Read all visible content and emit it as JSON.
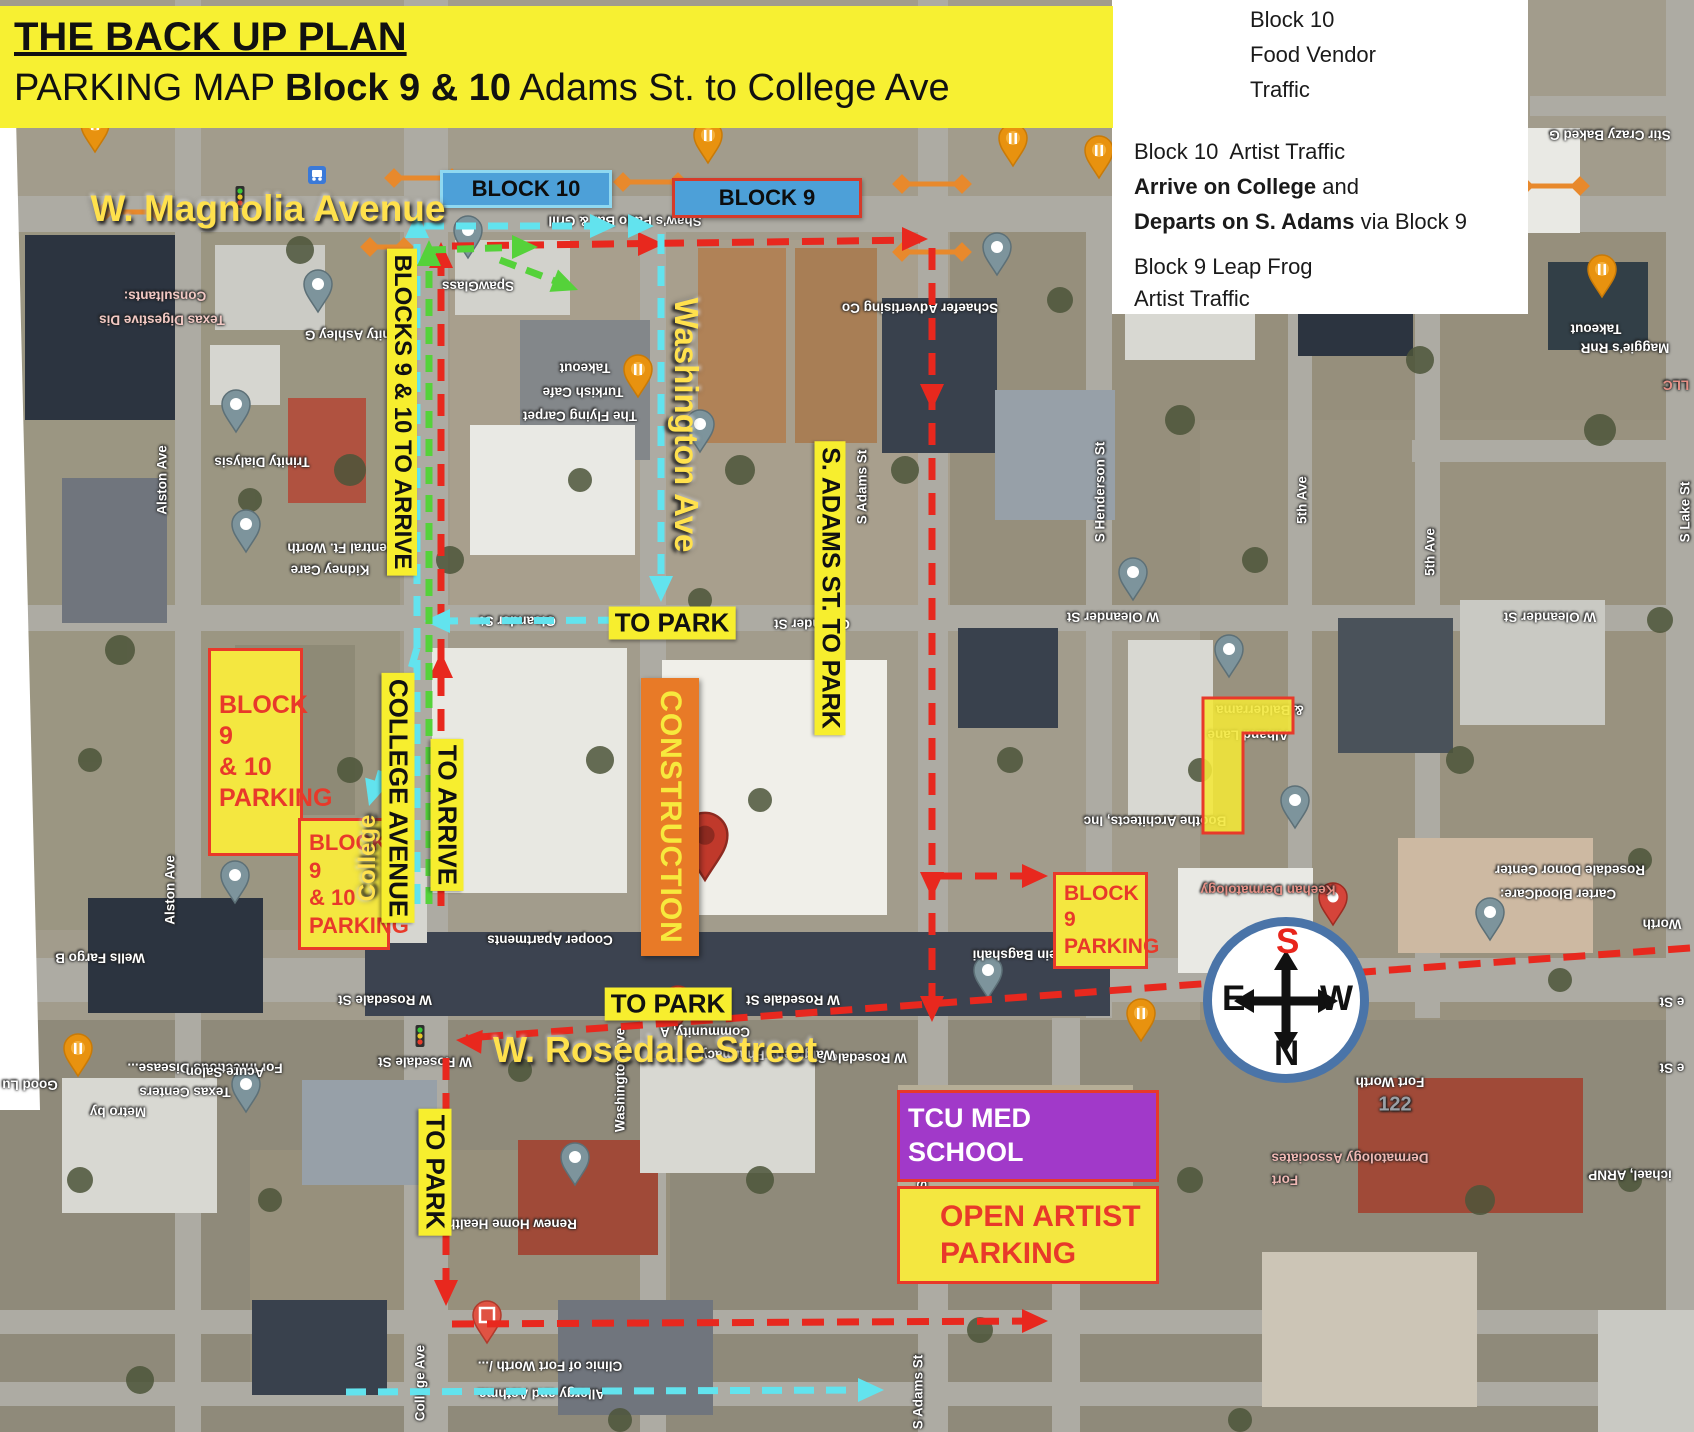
{
  "banner": {
    "title": "THE BACK UP PLAN",
    "subtitle_prefix": "PARKING MAP ",
    "subtitle_bold": "Block 9 & 10",
    "subtitle_suffix": " Adams St. to College Ave"
  },
  "legend": {
    "item1": {
      "l1": "Block 10",
      "l2": "Food Vendor",
      "l3": "Traffic"
    },
    "item2": {
      "l1": "Block 10  Artist Traffic",
      "l2b": "Arrive on College",
      "l2r": " and",
      "l3b": "Departs on S. Adams",
      "l3r": " via Block 9"
    },
    "item3": {
      "l1": "Block 9 Leap Frog",
      "l2": "Artist Traffic"
    }
  },
  "compass": {
    "top": "S",
    "left": "E",
    "right": "W",
    "bottom": "N"
  },
  "construction_label": "CONSTRUCTION",
  "colors": {
    "banner_yellow": "#f7f032",
    "label_yellow": "#f7ee2e",
    "street_text_yellow": "#ffe14d",
    "route_red": "#e8281e",
    "route_cyan": "#62e3ee",
    "route_green": "#55d23a",
    "closure_orange": "#e8892c",
    "construction_orange": "#e87a27",
    "parking_fill": "#f4e740",
    "parking_border": "#e8392a",
    "tcu_purple": "#a139c9",
    "block_tag_blue": "#4da0d8",
    "compass_ring_blue": "#4a74a8",
    "compass_s_red": "#e8251c"
  },
  "block_tags": [
    {
      "name": "block-10-tag",
      "label": "BLOCK 10",
      "x": 440,
      "y": 170,
      "w": 172,
      "h": 38,
      "fill": "#4da0d8",
      "border": "#8fd8f0",
      "size": 22
    },
    {
      "name": "block-9-tag",
      "label": "BLOCK 9",
      "x": 672,
      "y": 178,
      "w": 190,
      "h": 40,
      "fill": "#4da0d8",
      "border": "#d63a2a",
      "size": 22
    }
  ],
  "overlay_labels": [
    {
      "name": "magnolia-avenue-label",
      "text": "W. Magnolia Avenue",
      "x": 268,
      "y": 209,
      "rot": 0,
      "style": "ytext",
      "size": 37
    },
    {
      "name": "rosedale-street-label",
      "text": "W. Rosedale Street",
      "x": 655,
      "y": 1050,
      "rot": 0,
      "style": "ytext",
      "size": 36
    },
    {
      "name": "washington-ave-label",
      "text": "Washington Ave",
      "x": 686,
      "y": 425,
      "rot": 90,
      "style": "ytext",
      "size": 33
    },
    {
      "name": "college-script-label",
      "text": "College",
      "x": 368,
      "y": 858,
      "rot": -90,
      "style": "ytext",
      "size": 24
    },
    {
      "name": "blocks-9-10-to-arrive-label",
      "text": "BLOCKS 9 & 10 TO ARRIVE",
      "x": 402,
      "y": 412,
      "rot": 90,
      "style": "ybox",
      "size": 24
    },
    {
      "name": "s-adams-to-park-label",
      "text": "S. ADAMS ST. TO PARK",
      "x": 830,
      "y": 588,
      "rot": 90,
      "style": "ybox",
      "size": 25
    },
    {
      "name": "to-park-oleander-label",
      "text": "TO PARK",
      "x": 672,
      "y": 623,
      "rot": 0,
      "style": "ybox",
      "size": 26
    },
    {
      "name": "college-avenue-label",
      "text": "COLLEGE AVENUE",
      "x": 398,
      "y": 798,
      "rot": 90,
      "style": "ybox",
      "size": 26
    },
    {
      "name": "to-arrive-label",
      "text": "TO ARRIVE",
      "x": 447,
      "y": 815,
      "rot": 90,
      "style": "ybox",
      "size": 26
    },
    {
      "name": "to-park-rosedale-label",
      "text": "TO PARK",
      "x": 668,
      "y": 1004,
      "rot": 0,
      "style": "ybox",
      "size": 26
    },
    {
      "name": "to-park-college-label",
      "text": "TO PARK",
      "x": 435,
      "y": 1172,
      "rot": 90,
      "style": "ybox",
      "size": 26
    }
  ],
  "parking_boxes": [
    {
      "name": "block-9-10-parking-large",
      "lines": [
        "BLOCK 9",
        "& 10",
        "PARKING"
      ],
      "x": 208,
      "y": 648,
      "w": 95,
      "h": 208,
      "fill": "#f4e740",
      "border": "#e8392a",
      "text": "#e8392a",
      "size": 25
    },
    {
      "name": "block-9-10-parking-small",
      "lines": [
        "BLOCK 9",
        "& 10",
        "PARKING"
      ],
      "x": 298,
      "y": 818,
      "w": 92,
      "h": 132,
      "fill": "#f4e740",
      "border": "#e8392a",
      "text": "#e8392a",
      "size": 22
    },
    {
      "name": "block-9-parking",
      "lines": [
        "BLOCK 9",
        "PARKING"
      ],
      "x": 1053,
      "y": 872,
      "w": 95,
      "h": 97,
      "fill": "#f4e740",
      "border": "#e8392a",
      "text": "#e8392a",
      "size": 21
    },
    {
      "name": "tcu-med-school",
      "lines": [
        "TCU MED SCHOOL"
      ],
      "x": 897,
      "y": 1090,
      "w": 262,
      "h": 92,
      "fill": "#a139c9",
      "border": "#e8392a",
      "text": "#ffffff",
      "size": 27
    },
    {
      "name": "open-artist-parking",
      "lines": [
        "OPEN ARTIST",
        "PARKING"
      ],
      "x": 897,
      "y": 1186,
      "w": 262,
      "h": 98,
      "fill": "#f4e740",
      "border": "#e8392a",
      "text": "#e8392a",
      "size": 30
    }
  ],
  "highlight_lshape": {
    "name": "block-parking-highlight",
    "path": "M1203,698 L1293,698 L1293,733 L1243,733 L1243,833 L1203,833 Z",
    "fill": "#f2e738",
    "stroke": "#e8392a"
  },
  "routes": [
    {
      "name": "route-red-leapfrog",
      "color": "#e8281e",
      "width": 7,
      "dash": "22 13",
      "segments": [
        [
          [
            441,
            906
          ],
          [
            441,
            250
          ]
        ],
        [
          [
            452,
            246
          ],
          [
            920,
            240
          ]
        ],
        [
          [
            932,
            248
          ],
          [
            932,
            1016
          ]
        ],
        [
          [
            940,
            876
          ],
          [
            1040,
            876
          ]
        ],
        [
          [
            1690,
            948
          ],
          [
            466,
            1038
          ]
        ],
        [
          [
            446,
            1058
          ],
          [
            446,
            1298
          ]
        ],
        [
          [
            452,
            1324
          ],
          [
            1038,
            1321
          ]
        ]
      ],
      "arrows": [
        [
          441,
          652,
          -90
        ],
        [
          441,
          242,
          -90
        ],
        [
          664,
          244,
          0
        ],
        [
          928,
          239,
          0
        ],
        [
          932,
          410,
          90
        ],
        [
          932,
          898,
          90
        ],
        [
          932,
          1022,
          90
        ],
        [
          1048,
          876,
          0
        ],
        [
          456,
          1040,
          184
        ],
        [
          446,
          1306,
          90
        ],
        [
          1048,
          1321,
          0
        ]
      ]
    },
    {
      "name": "route-cyan-artist",
      "color": "#62e3ee",
      "width": 7,
      "dash": "20 12",
      "segments": [
        [
          [
            417,
            904
          ],
          [
            417,
            224
          ]
        ],
        [
          [
            424,
            226
          ],
          [
            600,
            226
          ]
        ],
        [
          [
            661,
            234
          ],
          [
            661,
            594
          ]
        ],
        [
          [
            650,
            620
          ],
          [
            434,
            621
          ]
        ],
        [
          [
            417,
            648
          ],
          [
            374,
            796
          ]
        ],
        [
          [
            346,
            1392
          ],
          [
            872,
            1390
          ]
        ]
      ],
      "arrows": [
        [
          417,
          212,
          -90
        ],
        [
          616,
          226,
          0
        ],
        [
          654,
          226,
          0
        ],
        [
          661,
          602,
          90
        ],
        [
          424,
          621,
          180
        ],
        [
          369,
          806,
          107
        ],
        [
          884,
          1390,
          0
        ]
      ]
    },
    {
      "name": "route-green-foodvendor",
      "color": "#55d23a",
      "width": 7,
      "dash": "17 11",
      "segments": [
        [
          [
            429,
            904
          ],
          [
            429,
            250
          ]
        ],
        [
          [
            429,
            250
          ],
          [
            528,
            247
          ]
        ],
        [
          [
            500,
            260
          ],
          [
            568,
            286
          ]
        ]
      ],
      "arrows": [
        [
          429,
          240,
          -90
        ],
        [
          538,
          247,
          0
        ],
        [
          578,
          290,
          21
        ]
      ]
    }
  ],
  "legend_arrows": [
    {
      "name": "legend-green-arrow",
      "color": "#55d23a",
      "seg": [
        [
          1118,
          25
        ],
        [
          1225,
          25
        ]
      ],
      "tip": [
        1237,
        25
      ]
    },
    {
      "name": "legend-cyan-arrow",
      "color": "#62e3ee",
      "seg": [
        [
          1125,
          118
        ],
        [
          1240,
          118
        ]
      ],
      "tip": [
        1252,
        118
      ]
    },
    {
      "name": "legend-red-arrow",
      "color": "#e8281e",
      "seg": [
        [
          1122,
          240
        ],
        [
          1232,
          240
        ]
      ],
      "tip": [
        1244,
        240
      ]
    }
  ],
  "closures": [
    [
      104,
      212,
      158,
      212
    ],
    [
      394,
      178,
      452,
      178
    ],
    [
      623,
      182,
      678,
      182
    ],
    [
      902,
      184,
      962,
      184
    ],
    [
      902,
      252,
      962,
      252
    ],
    [
      1524,
      186,
      1580,
      186
    ],
    [
      370,
      247,
      404,
      247
    ]
  ],
  "pins": [
    {
      "type": "gray",
      "x": 318,
      "y": 312
    },
    {
      "type": "gray",
      "x": 236,
      "y": 432
    },
    {
      "type": "gray",
      "x": 246,
      "y": 552
    },
    {
      "type": "gray",
      "x": 468,
      "y": 258
    },
    {
      "type": "gray",
      "x": 700,
      "y": 452
    },
    {
      "type": "gray",
      "x": 997,
      "y": 275
    },
    {
      "type": "gray",
      "x": 1133,
      "y": 600
    },
    {
      "type": "gray",
      "x": 1229,
      "y": 677
    },
    {
      "type": "gray",
      "x": 1295,
      "y": 828
    },
    {
      "type": "gray",
      "x": 1490,
      "y": 940
    },
    {
      "type": "gray",
      "x": 235,
      "y": 903
    },
    {
      "type": "gray",
      "x": 246,
      "y": 1112
    },
    {
      "type": "gray",
      "x": 575,
      "y": 1185
    },
    {
      "type": "gray",
      "x": 988,
      "y": 998
    },
    {
      "type": "food",
      "x": 95,
      "y": 152
    },
    {
      "type": "food",
      "x": 708,
      "y": 163
    },
    {
      "type": "food",
      "x": 1013,
      "y": 166
    },
    {
      "type": "food",
      "x": 1099,
      "y": 178
    },
    {
      "type": "food",
      "x": 638,
      "y": 397
    },
    {
      "type": "food",
      "x": 78,
      "y": 1076
    },
    {
      "type": "food",
      "x": 1141,
      "y": 1041
    },
    {
      "type": "food",
      "x": 1602,
      "y": 297
    },
    {
      "type": "red-big",
      "x": 705,
      "y": 880
    },
    {
      "type": "red",
      "x": 1333,
      "y": 925
    },
    {
      "type": "red-square",
      "x": 487,
      "y": 1343
    },
    {
      "type": "red",
      "x": 678,
      "y": 1028
    }
  ],
  "traffic_lights": [
    [
      240,
      197
    ],
    [
      420,
      1036
    ],
    [
      1338,
      1034
    ],
    [
      1086,
      952
    ]
  ],
  "transit_icons": [
    [
      317,
      175
    ]
  ],
  "map_labels": [
    {
      "text": "Consultants:",
      "x": 165,
      "y": 296,
      "rot": 180,
      "color": "#f2c9c4"
    },
    {
      "text": "Texas Digestive Dis",
      "x": 162,
      "y": 320,
      "rot": 180,
      "color": "#f2c9c4"
    },
    {
      "text": "Trinity Ashley G",
      "x": 356,
      "y": 335,
      "rot": 180
    },
    {
      "text": "Trinity Dialysis",
      "x": 262,
      "y": 462,
      "rot": 180
    },
    {
      "text": "Central Ft. Worth",
      "x": 342,
      "y": 548,
      "rot": 180
    },
    {
      "text": "Kidney Care",
      "x": 330,
      "y": 570,
      "rot": 180
    },
    {
      "text": "SpawGlass",
      "x": 478,
      "y": 286,
      "rot": 180
    },
    {
      "text": "Shaw's Patio Bar & Grill",
      "x": 625,
      "y": 221,
      "rot": 180
    },
    {
      "text": "Takeout",
      "x": 585,
      "y": 368,
      "rot": 180
    },
    {
      "text": "Turkish Cafe",
      "x": 583,
      "y": 392,
      "rot": 180
    },
    {
      "text": "The Flying Carpet",
      "x": 580,
      "y": 416,
      "rot": 180
    },
    {
      "text": "Schaefer Advertising Co",
      "x": 920,
      "y": 308,
      "rot": 180
    },
    {
      "text": "Oleander St",
      "x": 518,
      "y": 621,
      "rot": 180
    },
    {
      "text": "Oleander St",
      "x": 812,
      "y": 624,
      "rot": 180
    },
    {
      "text": "W Oleander St",
      "x": 1113,
      "y": 617,
      "rot": 180
    },
    {
      "text": "W Oleander St",
      "x": 1550,
      "y": 617,
      "rot": 180
    },
    {
      "text": "W Rosedale St",
      "x": 385,
      "y": 1000,
      "rot": 180
    },
    {
      "text": "W Rosedale St",
      "x": 793,
      "y": 1000,
      "rot": 180
    },
    {
      "text": "W Rosedale St",
      "x": 425,
      "y": 1062,
      "rot": 180
    },
    {
      "text": "W Rosedale St",
      "x": 860,
      "y": 1058,
      "rot": 180
    },
    {
      "text": "e St",
      "x": 1672,
      "y": 1002,
      "rot": 180
    },
    {
      "text": "e St",
      "x": 1672,
      "y": 1068,
      "rot": 180
    },
    {
      "text": "Cooper Apartments",
      "x": 550,
      "y": 940,
      "rot": 180
    },
    {
      "text": "Renew Home Health",
      "x": 512,
      "y": 1224,
      "rot": 180
    },
    {
      "text": "Community, A",
      "x": 705,
      "y": 1032,
      "rot": 180
    },
    {
      "text": "Walgreens Pharmacy",
      "x": 768,
      "y": 1055,
      "rot": 180
    },
    {
      "text": "Clinic of Fort Worth /...",
      "x": 550,
      "y": 1366,
      "rot": 180
    },
    {
      "text": "Allergy and Asthma",
      "x": 542,
      "y": 1394,
      "rot": 180
    },
    {
      "text": "For Infectious Disease...",
      "x": 205,
      "y": 1068,
      "rot": 180
    },
    {
      "text": "Texas Centers",
      "x": 185,
      "y": 1092,
      "rot": 180
    },
    {
      "text": "Good Lu",
      "x": 30,
      "y": 1085,
      "rot": 180
    },
    {
      "text": "Metro by",
      "x": 118,
      "y": 1112,
      "rot": 180
    },
    {
      "text": "Acure Salon",
      "x": 225,
      "y": 1072,
      "rot": 180
    },
    {
      "text": "Wells Fargo B",
      "x": 100,
      "y": 958,
      "rot": 180
    },
    {
      "text": "Keehan Dermatology",
      "x": 1268,
      "y": 890,
      "rot": 180,
      "color": "#e59086"
    },
    {
      "text": "Rosedale Donor Center",
      "x": 1570,
      "y": 870,
      "rot": 180
    },
    {
      "text": "Carter BloodCare:",
      "x": 1558,
      "y": 894,
      "rot": 180
    },
    {
      "text": "Boothe Architects, Inc",
      "x": 1155,
      "y": 821,
      "rot": 180
    },
    {
      "text": "& Balderrama",
      "x": 1260,
      "y": 710,
      "rot": 180
    },
    {
      "text": "Alhand Lane",
      "x": 1248,
      "y": 735,
      "rot": 180
    },
    {
      "text": "Dr. Hossein Bagshahi",
      "x": 1042,
      "y": 955,
      "rot": 180
    },
    {
      "text": "Maggie's RnR",
      "x": 1625,
      "y": 348,
      "rot": 180
    },
    {
      "text": "Takeout",
      "x": 1596,
      "y": 329,
      "rot": 180
    },
    {
      "text": "Stir Crazy Baked G",
      "x": 1610,
      "y": 135,
      "rot": 180
    },
    {
      "text": "Fort Worth",
      "x": 1390,
      "y": 1082,
      "rot": 180
    },
    {
      "text": "Worth",
      "x": 1662,
      "y": 924,
      "rot": 180
    },
    {
      "text": "Dermatology Associates",
      "x": 1350,
      "y": 1158,
      "rot": 180,
      "color": "#efb9b4"
    },
    {
      "text": "Fort",
      "x": 1285,
      "y": 1180,
      "rot": 180,
      "color": "#efb9b4"
    },
    {
      "text": "ichael, ARNP",
      "x": 1630,
      "y": 1175,
      "rot": 180
    },
    {
      "text": "122",
      "x": 1395,
      "y": 1105,
      "rot": 0,
      "color": "#9aa0a6",
      "size": 20
    },
    {
      "text": "LLC",
      "x": 1676,
      "y": 385,
      "rot": 180,
      "color": "#e59086"
    },
    {
      "text": "Alston Ave",
      "x": 162,
      "y": 480,
      "rot": -90
    },
    {
      "text": "Alston Ave",
      "x": 170,
      "y": 890,
      "rot": -90
    },
    {
      "text": "College Ave",
      "x": 420,
      "y": 1383,
      "rot": -90
    },
    {
      "text": "Washington Ave",
      "x": 620,
      "y": 1080,
      "rot": -90
    },
    {
      "text": "S Adams St",
      "x": 862,
      "y": 487,
      "rot": -90
    },
    {
      "text": "S Adams St",
      "x": 922,
      "y": 1152,
      "rot": -90
    },
    {
      "text": "S Adams St",
      "x": 918,
      "y": 1392,
      "rot": -90
    },
    {
      "text": "S Henderson St",
      "x": 1100,
      "y": 492,
      "rot": -90
    },
    {
      "text": "5th Ave",
      "x": 1302,
      "y": 500,
      "rot": -90
    },
    {
      "text": "5th Ave",
      "x": 1430,
      "y": 552,
      "rot": -90
    },
    {
      "text": "S Lake St",
      "x": 1685,
      "y": 512,
      "rot": -90
    }
  ]
}
